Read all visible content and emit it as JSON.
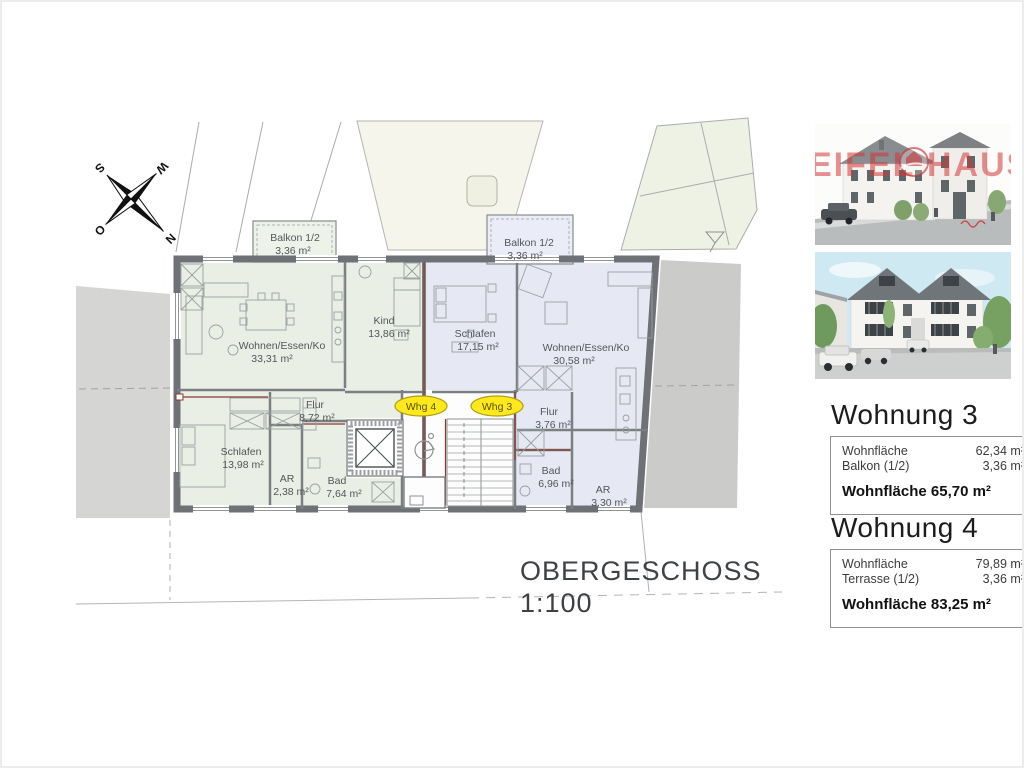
{
  "title": {
    "floor": "OBERGESCHOSS",
    "scale": "1:100"
  },
  "compass": {
    "n": "N",
    "s": "S",
    "w": "W",
    "o": "O"
  },
  "plan": {
    "whg4": {
      "tag": "Whg 4",
      "balcony_name": "Balkon 1/2",
      "balcony_area": "3,36 m²",
      "rooms": [
        {
          "name": "Wohnen/Essen/Ko",
          "area": "33,31 m²"
        },
        {
          "name": "Kind",
          "area": "13,86 m²"
        },
        {
          "name": "Flur",
          "area": "8,72 m²"
        },
        {
          "name": "Schlafen",
          "area": "13,98 m²"
        },
        {
          "name": "AR",
          "area": "2,38 m²"
        },
        {
          "name": "Bad",
          "area": "7,64 m²"
        }
      ]
    },
    "whg3": {
      "tag": "Whg 3",
      "balcony_name": "Balkon 1/2",
      "balcony_area": "3,36 m²",
      "rooms": [
        {
          "name": "Schlafen",
          "area": "17,15 m²"
        },
        {
          "name": "Wohnen/Essen/Ko",
          "area": "30,58 m²"
        },
        {
          "name": "Flur",
          "area": "3,76 m²"
        },
        {
          "name": "Bad",
          "area": "6,96 m²"
        },
        {
          "name": "AR",
          "area": "3,30 m²"
        }
      ]
    }
  },
  "sidebar": {
    "brand": {
      "left": "EIFEL",
      "right": "HAUS"
    },
    "apartments": [
      {
        "heading": "Wohnung 3",
        "rows": [
          {
            "label": "Wohnfläche",
            "value": "62,34 m²"
          },
          {
            "label": "Balkon (1/2)",
            "value": "3,36 m²"
          }
        ],
        "total": "Wohnfläche 65,70 m²"
      },
      {
        "heading": "Wohnung 4",
        "rows": [
          {
            "label": "Wohnfläche",
            "value": "79,89 m²"
          },
          {
            "label": "Terrasse (1/2)",
            "value": "3,36 m²"
          }
        ],
        "total": "Wohnfläche 83,25 m²"
      }
    ]
  },
  "colors": {
    "apartment4_fill": "#e9efe4",
    "apartment3_fill": "#e6e9f3",
    "wall_gray": "#6e7277",
    "road_gray": "#d5d6d3",
    "accent_red": "#8b3a2e",
    "tag_yellow": "#ffe81c",
    "brand_red": "#d14a4a"
  }
}
